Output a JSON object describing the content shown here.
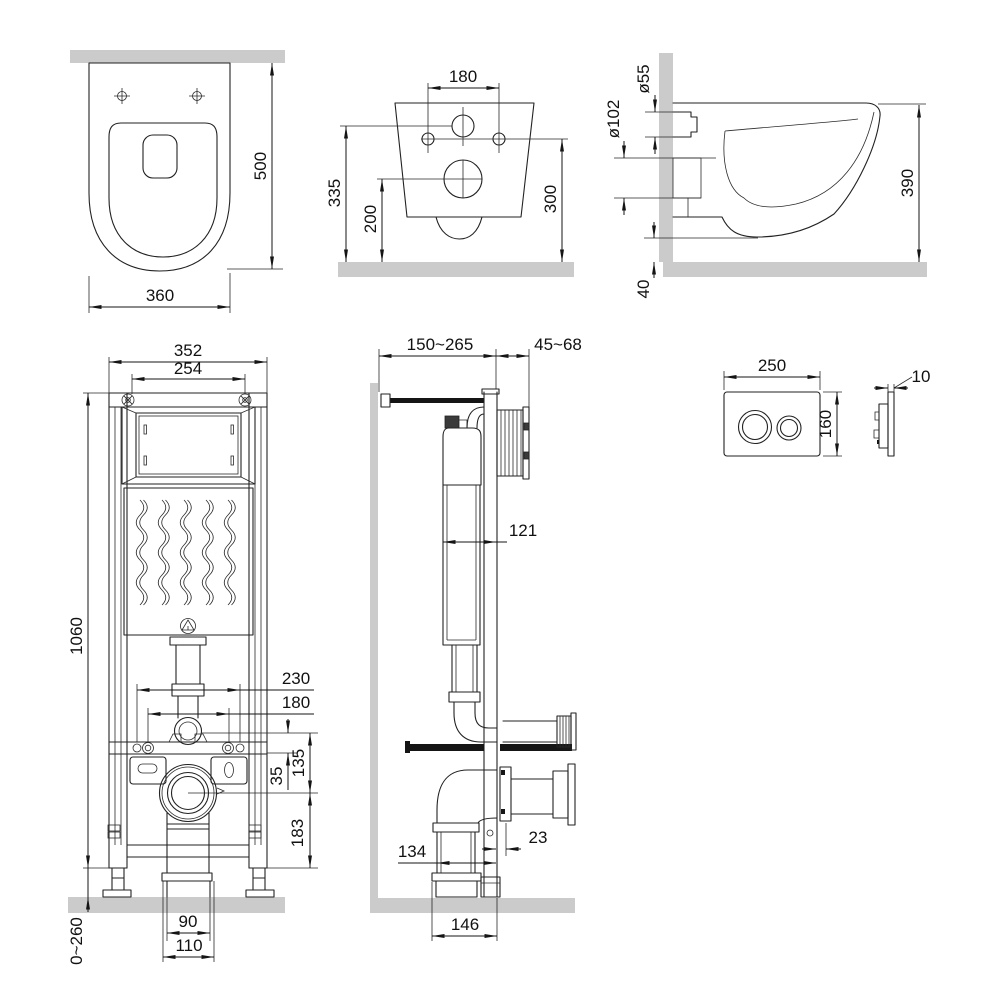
{
  "drawing_title": "Wall-hung toilet and concealed installation frame dimensional drawing",
  "views": {
    "toilet_top": {
      "dims": {
        "depth": "500",
        "width": "360"
      }
    },
    "toilet_rear": {
      "dims": {
        "hole_spacing": "180",
        "inlet_height": "335",
        "outlet_height": "200",
        "mount_height": "300"
      }
    },
    "toilet_side": {
      "dims": {
        "inlet_diameter": "ø55",
        "outlet_diameter": "ø102",
        "depth": "390",
        "bottom_clearance": "40"
      }
    },
    "frame_front": {
      "dims": {
        "width": "352",
        "bracket_spacing": "254",
        "height": "1060",
        "anchor_spacing_outer": "230",
        "anchor_spacing_inner": "180",
        "offset_inlet_bar": "35",
        "inlet_to_outlet": "135",
        "outlet_to_bottom": "183",
        "foot_adjust": "0~260",
        "drain_width": "90",
        "drain_flange_width": "110"
      }
    },
    "frame_side": {
      "dims": {
        "depth_adjust": "150~265",
        "wall_embed": "45~68",
        "tank_depth": "121",
        "outlet_offset": "23",
        "drain_offset": "134",
        "base_depth": "146"
      }
    },
    "flush_plate": {
      "dims": {
        "width": "250",
        "height": "160",
        "thickness": "10"
      }
    }
  }
}
